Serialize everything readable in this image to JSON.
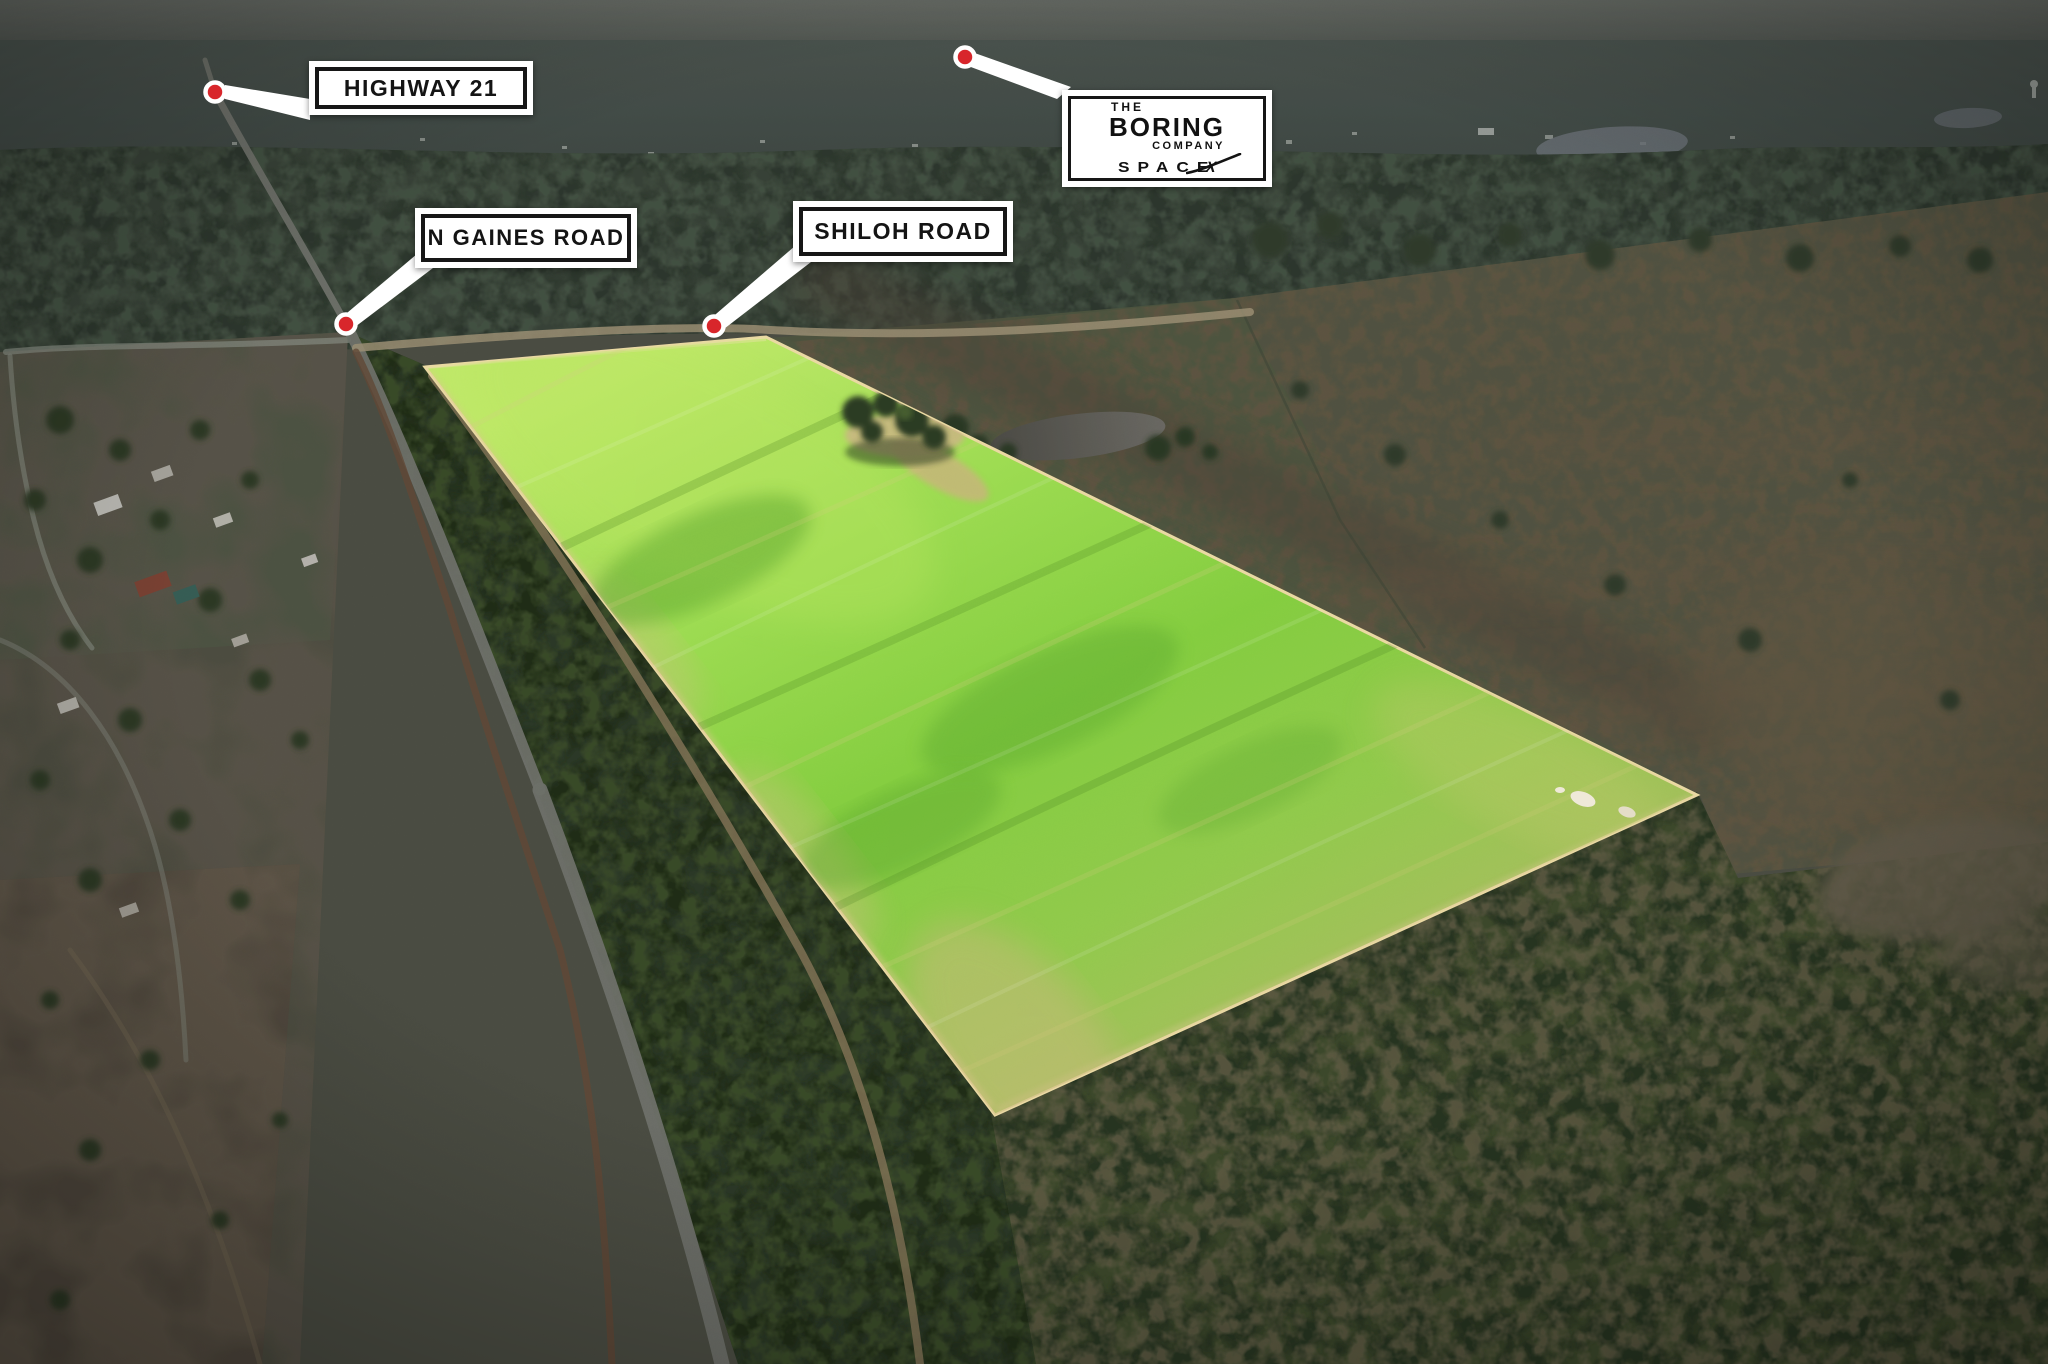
{
  "annotations": {
    "highway_21": "HIGHWAY 21",
    "n_gaines_road": "N GAINES ROAD",
    "shiloh_road": "SHILOH ROAD"
  },
  "logo_card": {
    "line_the": "THE",
    "line_boring": "BORING",
    "line_company": "COMPANY",
    "spacex_space": "SPACE",
    "spacex_x": "X"
  },
  "colors": {
    "marker": "#d8262b",
    "label_background": "#ffffff",
    "label_frame": "#161616",
    "field_highlight": "#83cd3f",
    "leader_line": "#ffffff"
  }
}
